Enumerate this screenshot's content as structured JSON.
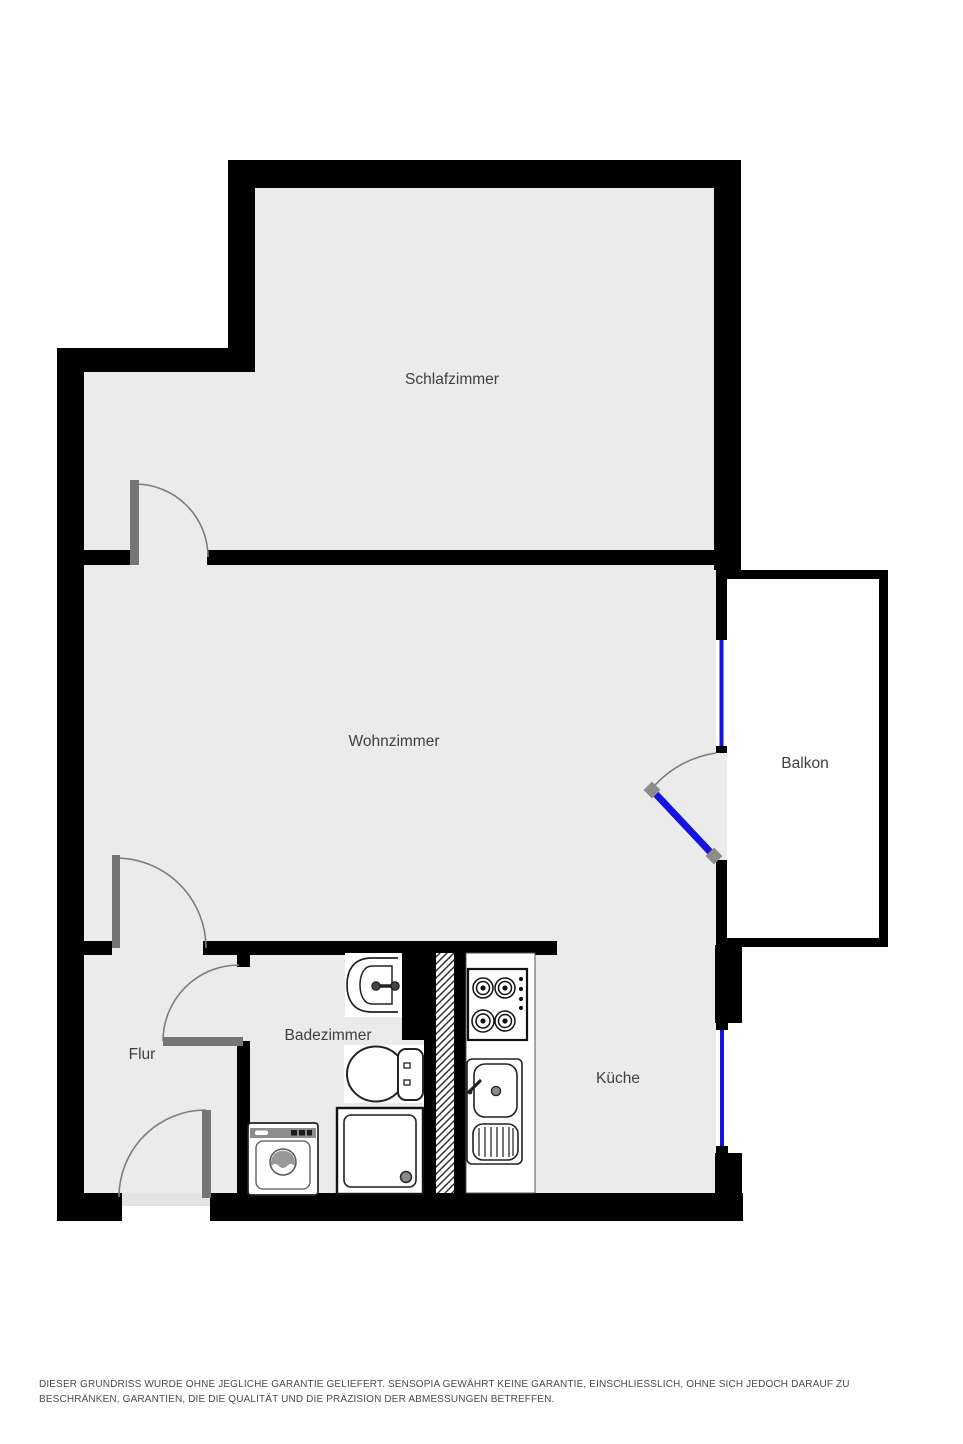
{
  "plan": {
    "rooms": [
      {
        "id": "schlafzimmer",
        "label": "Schlafzimmer"
      },
      {
        "id": "wohnzimmer",
        "label": "Wohnzimmer"
      },
      {
        "id": "balkon",
        "label": "Balkon"
      },
      {
        "id": "flur",
        "label": "Flur"
      },
      {
        "id": "badezimmer",
        "label": "Badezimmer"
      },
      {
        "id": "kueche",
        "label": "Küche"
      }
    ],
    "fixtures": {
      "badezimmer": [
        "washbasin",
        "toilet",
        "shower",
        "washing-machine"
      ],
      "kueche": [
        "stove",
        "kitchen-sink"
      ],
      "shaft": "ventilation-shaft"
    },
    "colors": {
      "wall": "#000000",
      "floor": "#ebebeb",
      "balcony_floor": "#ffffff",
      "door_leaf_gray": "#757575",
      "window_blue": "#1414e0",
      "label_text": "#3d4043"
    }
  },
  "footer": {
    "disclaimer": "DIESER GRUNDRISS WURDE OHNE JEGLICHE GARANTIE GELIEFERT. SENSOPIA GEWÄHRT KEINE GARANTIE, EINSCHLIESSLICH, OHNE SICH JEDOCH DARAUF ZU BESCHRÄNKEN, GARANTIEN, DIE DIE QUALITÄT UND DIE PRÄZISION DER ABMESSUNGEN BETREFFEN."
  }
}
